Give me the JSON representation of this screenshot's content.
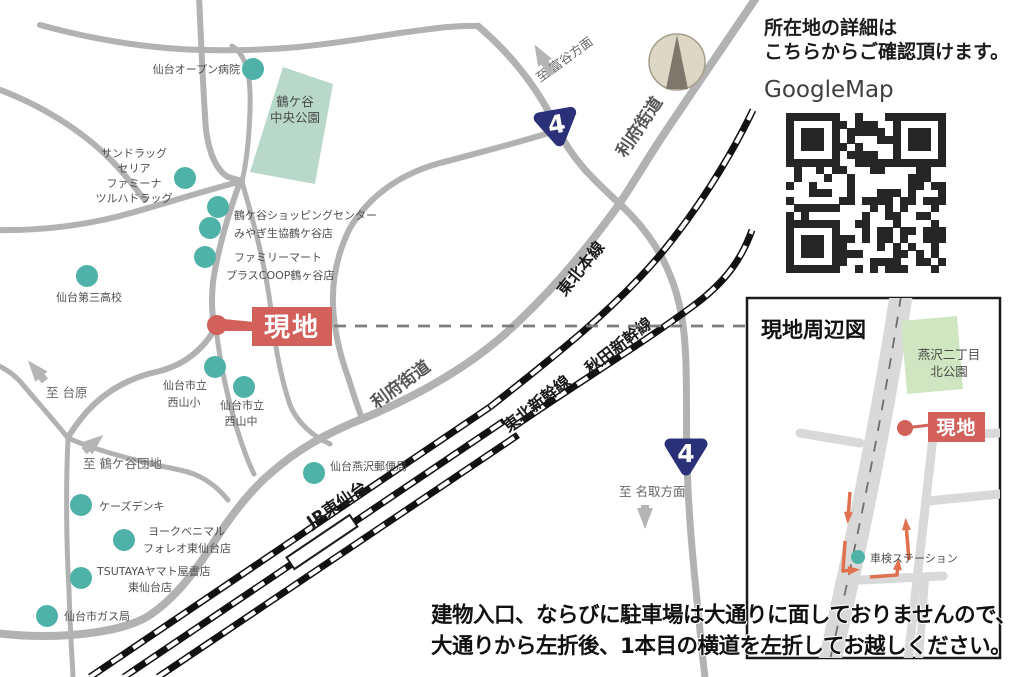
{
  "header": {
    "line1": "所在地の詳細は",
    "line2": "こちらからご確認頂けます。",
    "map_service": "GoogleMap"
  },
  "site": {
    "label": "現地"
  },
  "main_map": {
    "park": {
      "line1": "鶴ケ谷",
      "line2": "中央公園"
    },
    "roads": {
      "lifu_upper": "利府街道",
      "lifu_lower": "利府街道",
      "route_number": "4"
    },
    "railways": {
      "tohoku_main": "東北本線",
      "tohoku_shinkansen": "東北新幹線",
      "akita_shinkansen": "秋田新幹線",
      "station": "JR東仙台"
    },
    "directions": {
      "tomiya": "至 富谷方面",
      "dainohara": "至 台原",
      "tsurugaya": "至 鶴ケ谷団地",
      "natori": "至 名取方面"
    },
    "pois": {
      "open_hospital": "仙台オープン病院",
      "drug_1": "サンドラッグ",
      "drug_2": "セリア",
      "drug_3": "ファミーナ",
      "drug_4": "ツルハドラッグ",
      "shopping_center": "鶴ケ谷ショッピングセンター",
      "coop": "みやぎ生協鶴ケ谷店",
      "familymart_1": "ファミリーマート",
      "familymart_2": "プラスCOOP鶴ヶ谷店",
      "daisan_high": "仙台第三高校",
      "nishiyama_es_1": "仙台市立",
      "nishiyama_es_2": "西山小",
      "nishiyama_jhs_1": "仙台市立",
      "nishiyama_jhs_2": "西山中",
      "post_office": "仙台燕沢郵便局",
      "ks_denki": "ケーズデンキ",
      "york_1": "ヨークベニマル",
      "york_2": "フォレオ東仙台店",
      "tsutaya_1": "TSUTAYAヤマト屋書店",
      "tsutaya_2": "東仙台店",
      "gas": "仙台市ガス局"
    }
  },
  "inset": {
    "title": "現地周辺図",
    "park_line1": "燕沢二丁目",
    "park_line2": "北公園",
    "site_label": "現地",
    "shaken": "車検ステーション"
  },
  "caption": {
    "line1": "建物入口、ならびに駐車場は大通りに面しておりませんので、",
    "line2": "大通りから左折後、1本目の横道を左折してお越しください。"
  },
  "colors": {
    "poi_teal": "#4fb2a8",
    "site_red": "#d2605b",
    "route_navy": "#2b3178",
    "park_green": "#b8d8ca",
    "inset_park_green": "#cfe6c1",
    "road_gray": "#b2b2b2",
    "inset_road_gray": "#d9d9d9",
    "route_arrow_orange": "#e0714e"
  }
}
